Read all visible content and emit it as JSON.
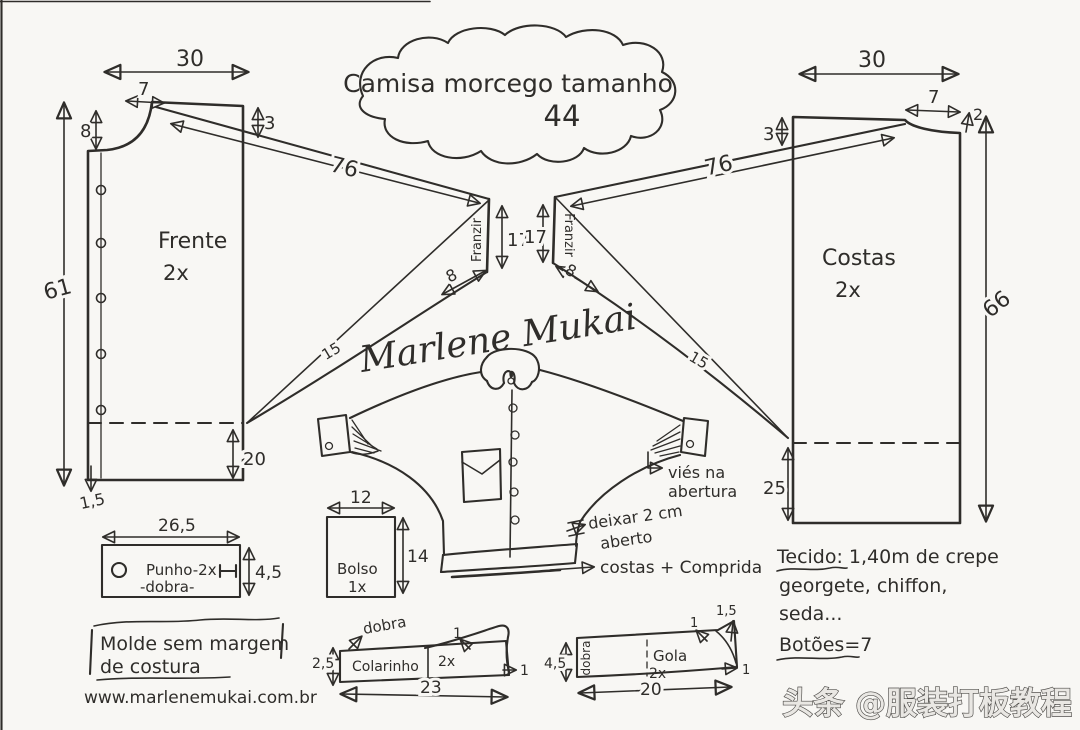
{
  "title": {
    "line1": "Camisa morcego tamanho",
    "line2": "44"
  },
  "frente": {
    "label": "Frente",
    "qty": "2x",
    "width": "30",
    "neck_width": "7",
    "neck_depth": "8",
    "shoulder_drop": "3",
    "length": "61",
    "slit": "20",
    "hem": "1,5"
  },
  "costas": {
    "label": "Costas",
    "qty": "2x",
    "width": "30",
    "neck_width": "7",
    "neck_depth": "2",
    "shoulder_drop": "3",
    "length": "66",
    "slit": "25"
  },
  "manga_esq": {
    "comprimento": "76",
    "franzir": "Franzir",
    "altura_punho": "17",
    "abertura": "8",
    "largura": "15"
  },
  "manga_dir": {
    "comprimento": "76",
    "franzir": "Franzir",
    "altura_punho": "17",
    "abertura": "8",
    "largura": "15"
  },
  "punho": {
    "label": "Punho-2x",
    "dobra": "-dobra-",
    "width": "26,5",
    "height": "4,5"
  },
  "bolso": {
    "label": "Bolso",
    "qty": "1x",
    "width": "12",
    "height": "14"
  },
  "colarinho": {
    "label": "Colarinho",
    "qty": "2x",
    "dobra": "dobra",
    "height": "2,5",
    "width": "23",
    "tip_top": "1",
    "tip_right": "1"
  },
  "gola": {
    "label": "Gola",
    "qty": "2x",
    "dobra": "dobra",
    "height": "4,5",
    "width": "20",
    "tip_top": "1",
    "tip_rise": "1,5",
    "tip_right": "1"
  },
  "notas": {
    "vies1": "viés na",
    "vies2": "abertura",
    "abrir1": "deixar 2 cm",
    "abrir2": "aberto",
    "costas_longa": "costas + Comprida",
    "molde1": "Molde sem margem",
    "molde2": "de costura",
    "site": "www.marlenemukai.com.br"
  },
  "tecido": {
    "l1": "Tecido: 1,40m de  crepe",
    "l2": "georgete, chiffon,",
    "l3": "seda...",
    "l4": "Botões=7"
  },
  "assinatura": "Marlene Mukai",
  "watermark": "头条 @服装打板教程",
  "ink": "#2f2d2a",
  "paper": "#f8f7f4"
}
